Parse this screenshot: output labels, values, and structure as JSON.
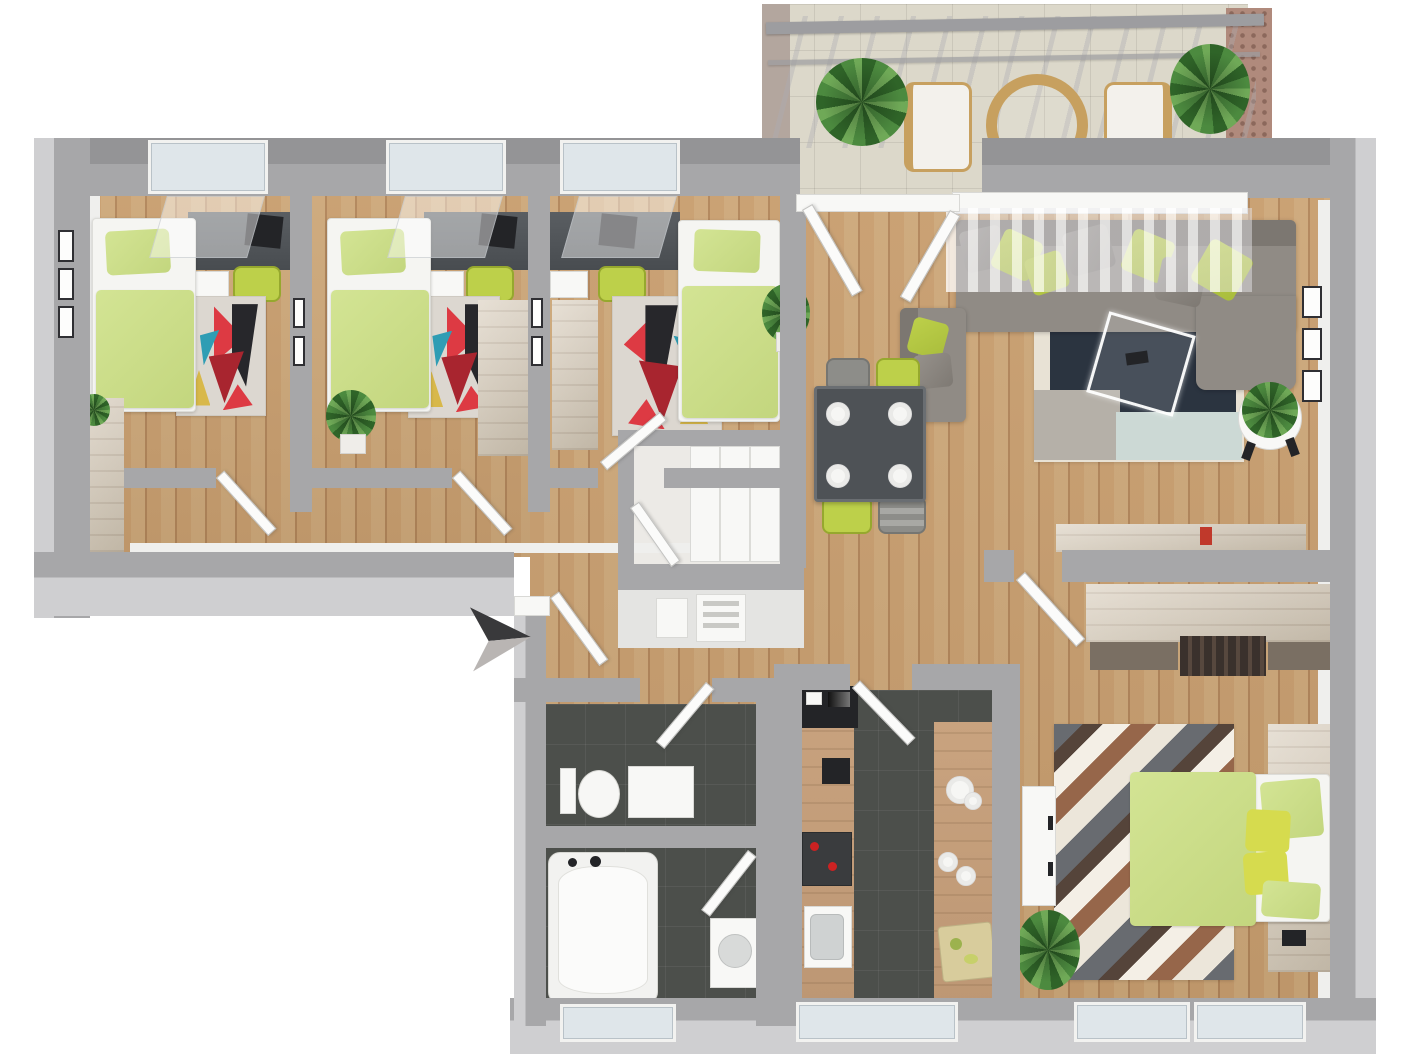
{
  "meta": {
    "type": "3d-floor-plan-render",
    "view": "top-down isometric",
    "visible_text": "none",
    "description": "Rendered 3D floor plan of an apartment: three children/single bedrooms on the left wing, hallway, storage closet, open living-dining room with balcony at top right, galley kitchen, WC, bathroom and master bedroom along the bottom, entrance marked with an arrow."
  },
  "palette": {
    "bg": "#ffffff",
    "wall": "#a7a7a9",
    "wall-dark": "#949496",
    "wall-light": "#cfcfd1",
    "inner-face": "#efefed",
    "door-white": "#fbfbfa",
    "wood": "#c89e6f",
    "wood-alt": "#cda87a",
    "wood-shade": "#b1855a",
    "tile": "#dcd8ca",
    "dark-floor": "#4c4f4b",
    "counter-wood": "#c9a37f",
    "light-wood": "#ded4c5",
    "light-wood-2": "#cfc4b2",
    "bed-green": "#d3e494",
    "bed-green-2": "#c3d67e",
    "accent-green": "#bdd04a",
    "sofa": "#908b85",
    "sofa-dark": "#7c7771",
    "table-dark": "#4e5256",
    "rug-base": "#dcd7d0",
    "cream": "#e8e2d5",
    "navy": "#2b3440",
    "orange": "#d98f63",
    "lt-blue": "#ccd9d5",
    "rug-gray": "#b5b0a8",
    "red": "#dd3a43",
    "crimson": "#a8252f",
    "teal": "#2f9db4",
    "near-black": "#27272b",
    "mustard": "#d8b84a",
    "chev-gray": "#686b70",
    "chev-cream": "#ece6da",
    "chev-brown": "#96664a",
    "chev-white": "#f4efe6",
    "chev-dark": "#55443a",
    "plant-dark": "#2f6428",
    "plant-mid": "#4c8a3f",
    "plant-light": "#6fa957",
    "brick": "#b08a7c",
    "arrow-dark": "#39393b",
    "arrow-light": "#b9b5b3"
  },
  "rooms": {
    "bedroom_1": {
      "label": "Bedroom 1",
      "floor": "wood",
      "furniture": [
        "single-bed",
        "desk",
        "desk-chair",
        "drawer-unit",
        "colorful-rug",
        "wardrobe",
        "wall-frames",
        "plant"
      ]
    },
    "bedroom_2": {
      "label": "Bedroom 2",
      "floor": "wood",
      "furniture": [
        "single-bed",
        "desk",
        "desk-chair",
        "drawer-unit",
        "colorful-rug",
        "wardrobe",
        "plant"
      ]
    },
    "bedroom_3": {
      "label": "Bedroom 3",
      "floor": "wood",
      "furniture": [
        "single-bed",
        "desk",
        "desk-chair",
        "drawer-unit",
        "colorful-rug",
        "wardrobe"
      ]
    },
    "hallway": {
      "label": "Hallway",
      "floor": "wood"
    },
    "storage": {
      "label": "Storage closet",
      "floor": "light",
      "furniture": [
        "white-wardrobe",
        "utility-panels"
      ]
    },
    "living_room": {
      "label": "Living room",
      "floor": "wood",
      "furniture": [
        "corner-sofa",
        "armchair",
        "glass-coffee-table",
        "patchwork-rug",
        "dining-table",
        "dining-chairs",
        "sideboard",
        "plant-on-stool",
        "plant",
        "wall-art",
        "curtains"
      ],
      "dining_chair_colors": [
        "gray",
        "green",
        "green",
        "gray"
      ],
      "plate_count": 4
    },
    "balcony": {
      "label": "Balcony",
      "floor": "tile",
      "furniture": [
        "round-table",
        "chair",
        "chair",
        "plant",
        "plant",
        "pergola",
        "brick-privacy-wall"
      ]
    },
    "kitchen": {
      "label": "Kitchen",
      "floor": "dark-tile",
      "furniture": [
        "counter-left",
        "counter-right",
        "built-in-appliances",
        "stove",
        "sink",
        "plates",
        "cutting-board"
      ]
    },
    "wc": {
      "label": "WC",
      "floor": "dark-tile",
      "furniture": [
        "toilet",
        "cabinet"
      ]
    },
    "bathroom": {
      "label": "Bathroom",
      "floor": "dark-tile",
      "furniture": [
        "bathtub",
        "washbasin"
      ]
    },
    "master_bedroom": {
      "label": "Master bedroom",
      "floor": "wood",
      "furniture": [
        "double-bed",
        "wardrobe",
        "dresser",
        "chevron-rug",
        "bookshelf",
        "plant"
      ]
    }
  },
  "labels": {
    "single_bed": "Single bed",
    "double_bed": "Double bed",
    "desk": "Desk",
    "desk_chair": "Desk chair",
    "drawer_unit": "Drawer unit",
    "wardrobe": "Wardrobe",
    "white_wardrobe": "Wardrobe",
    "rug": "Rug",
    "sofa": "Corner sofa",
    "armchair": "Armchair",
    "coffee_table": "Glass coffee table",
    "dining_table": "Dining table",
    "dining_chair": "Dining chair",
    "sideboard": "Sideboard",
    "plant": "Plant",
    "toilet": "Toilet",
    "cabinet": "Cabinet",
    "bathtub": "Bathtub",
    "washbasin": "Washbasin",
    "counter": "Kitchen counter",
    "stove": "Stove",
    "sink": "Sink",
    "cutting_board": "Cutting board",
    "balcony_table": "Round table",
    "balcony_chair": "Chair",
    "pergola": "Pergola",
    "privacy_wall": "Brick privacy wall",
    "door": "Door",
    "window": "Window",
    "curtains": "Curtains",
    "wall_art": "Wall art",
    "bookshelf": "Bookshelf",
    "dresser": "Dresser",
    "utility_panel": "Utility panel",
    "entrance_arrow": "Entrance arrow",
    "floor_plan": "3D floor plan"
  }
}
